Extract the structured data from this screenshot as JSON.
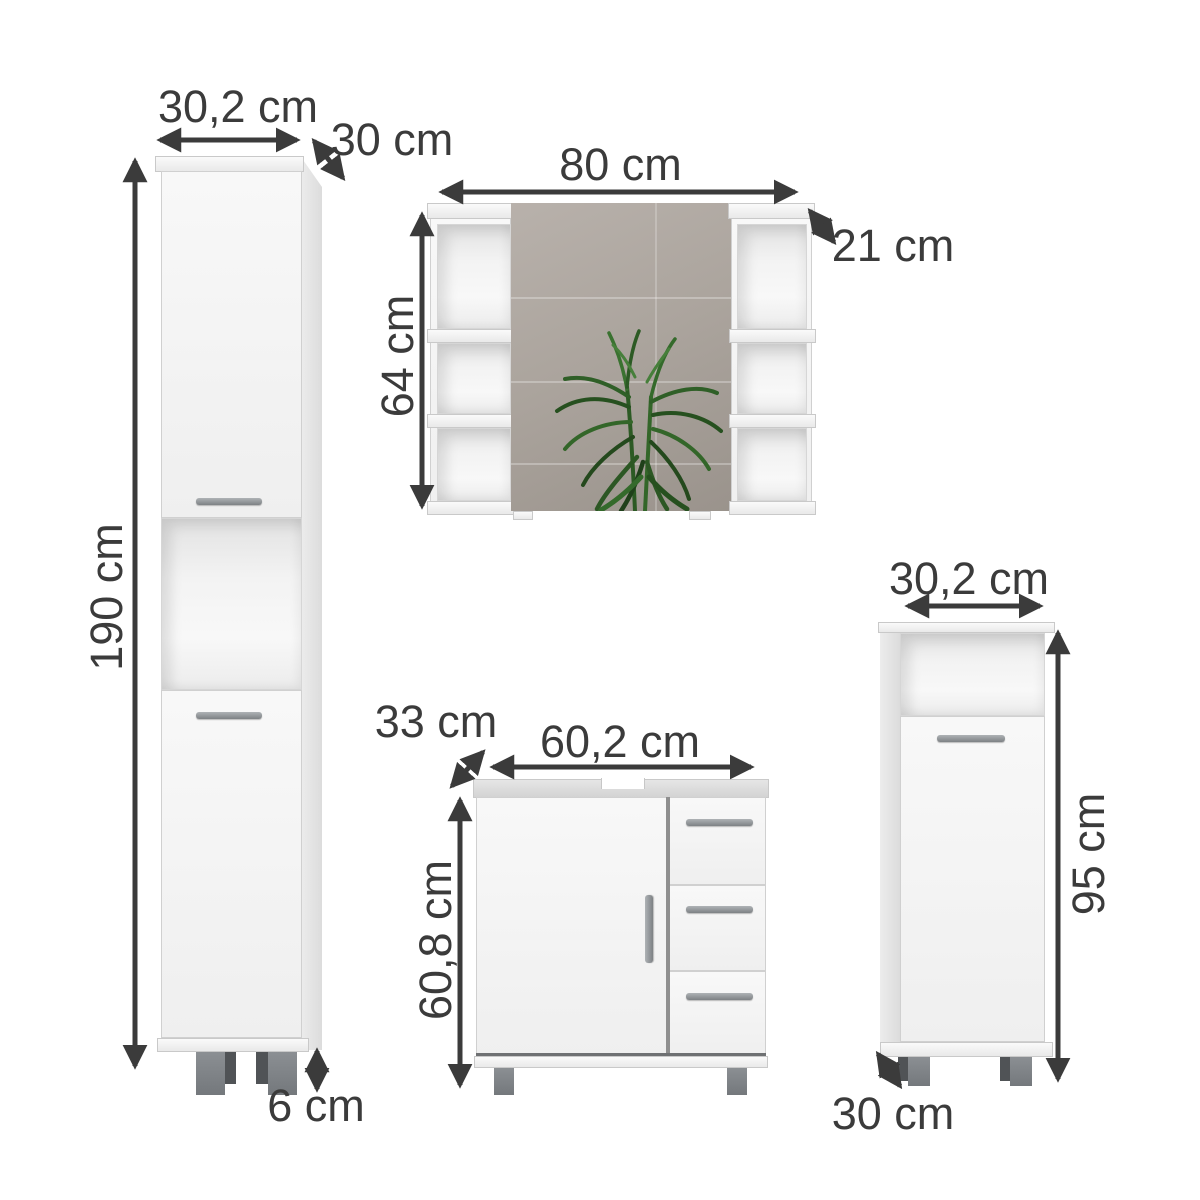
{
  "items": {
    "tall_cabinet": {
      "width": "30,2 cm",
      "depth": "30 cm",
      "height": "190 cm",
      "feet_height": "6 cm"
    },
    "mirror_cabinet": {
      "width": "80 cm",
      "depth": "21 cm",
      "height": "64 cm"
    },
    "vanity_cabinet": {
      "depth": "33 cm",
      "width": "60,2 cm",
      "height": "60,8 cm"
    },
    "side_cabinet": {
      "width": "30,2 cm",
      "height": "95 cm",
      "depth": "30 cm"
    }
  },
  "colors": {
    "annotation": "#3b3b3b",
    "furniture_face": "#f4f4f4",
    "furniture_side": "#dedede",
    "handle": "#8f9396",
    "foot": "#7f8387",
    "mirror": "#aba49d",
    "plant_green": "#2e5b27",
    "background": "#ffffff"
  }
}
